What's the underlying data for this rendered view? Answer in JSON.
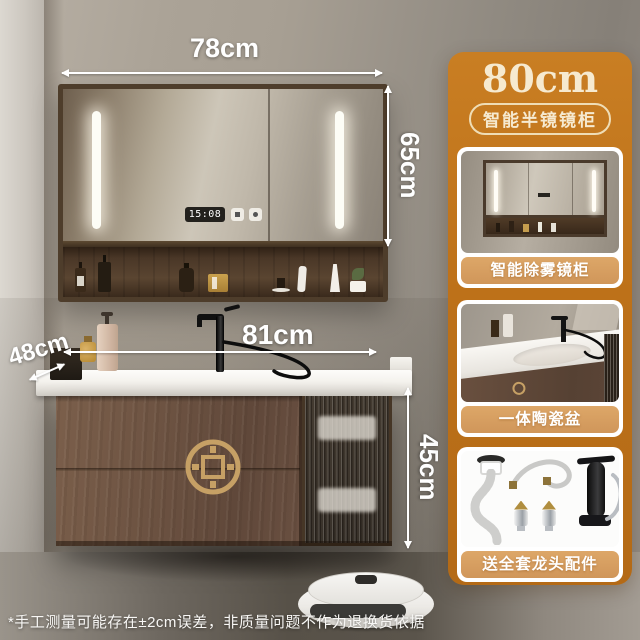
{
  "dimensions": {
    "mirror_width": "78cm",
    "mirror_height": "65cm",
    "counter_width": "81cm",
    "counter_depth": "48cm",
    "cabinet_height": "45cm"
  },
  "mirror": {
    "clock": "15:08"
  },
  "panel": {
    "title": "80cm",
    "badge": "智能半镜镜柜",
    "cards": [
      {
        "label": "智能除雾镜柜"
      },
      {
        "label": "一体陶瓷盆"
      },
      {
        "label": "送全套龙头配件"
      }
    ]
  },
  "footer": {
    "disclaimer": "*手工测量可能存在±2cm误差，非质量问题不作为退换货依据"
  },
  "colors": {
    "panel_orange": "#bf7420",
    "card_label_tan": "#d89e5e",
    "cream_text": "#f6ead0",
    "emblem_gold": "#c6a065",
    "walnut_wood": "#6b5140"
  }
}
